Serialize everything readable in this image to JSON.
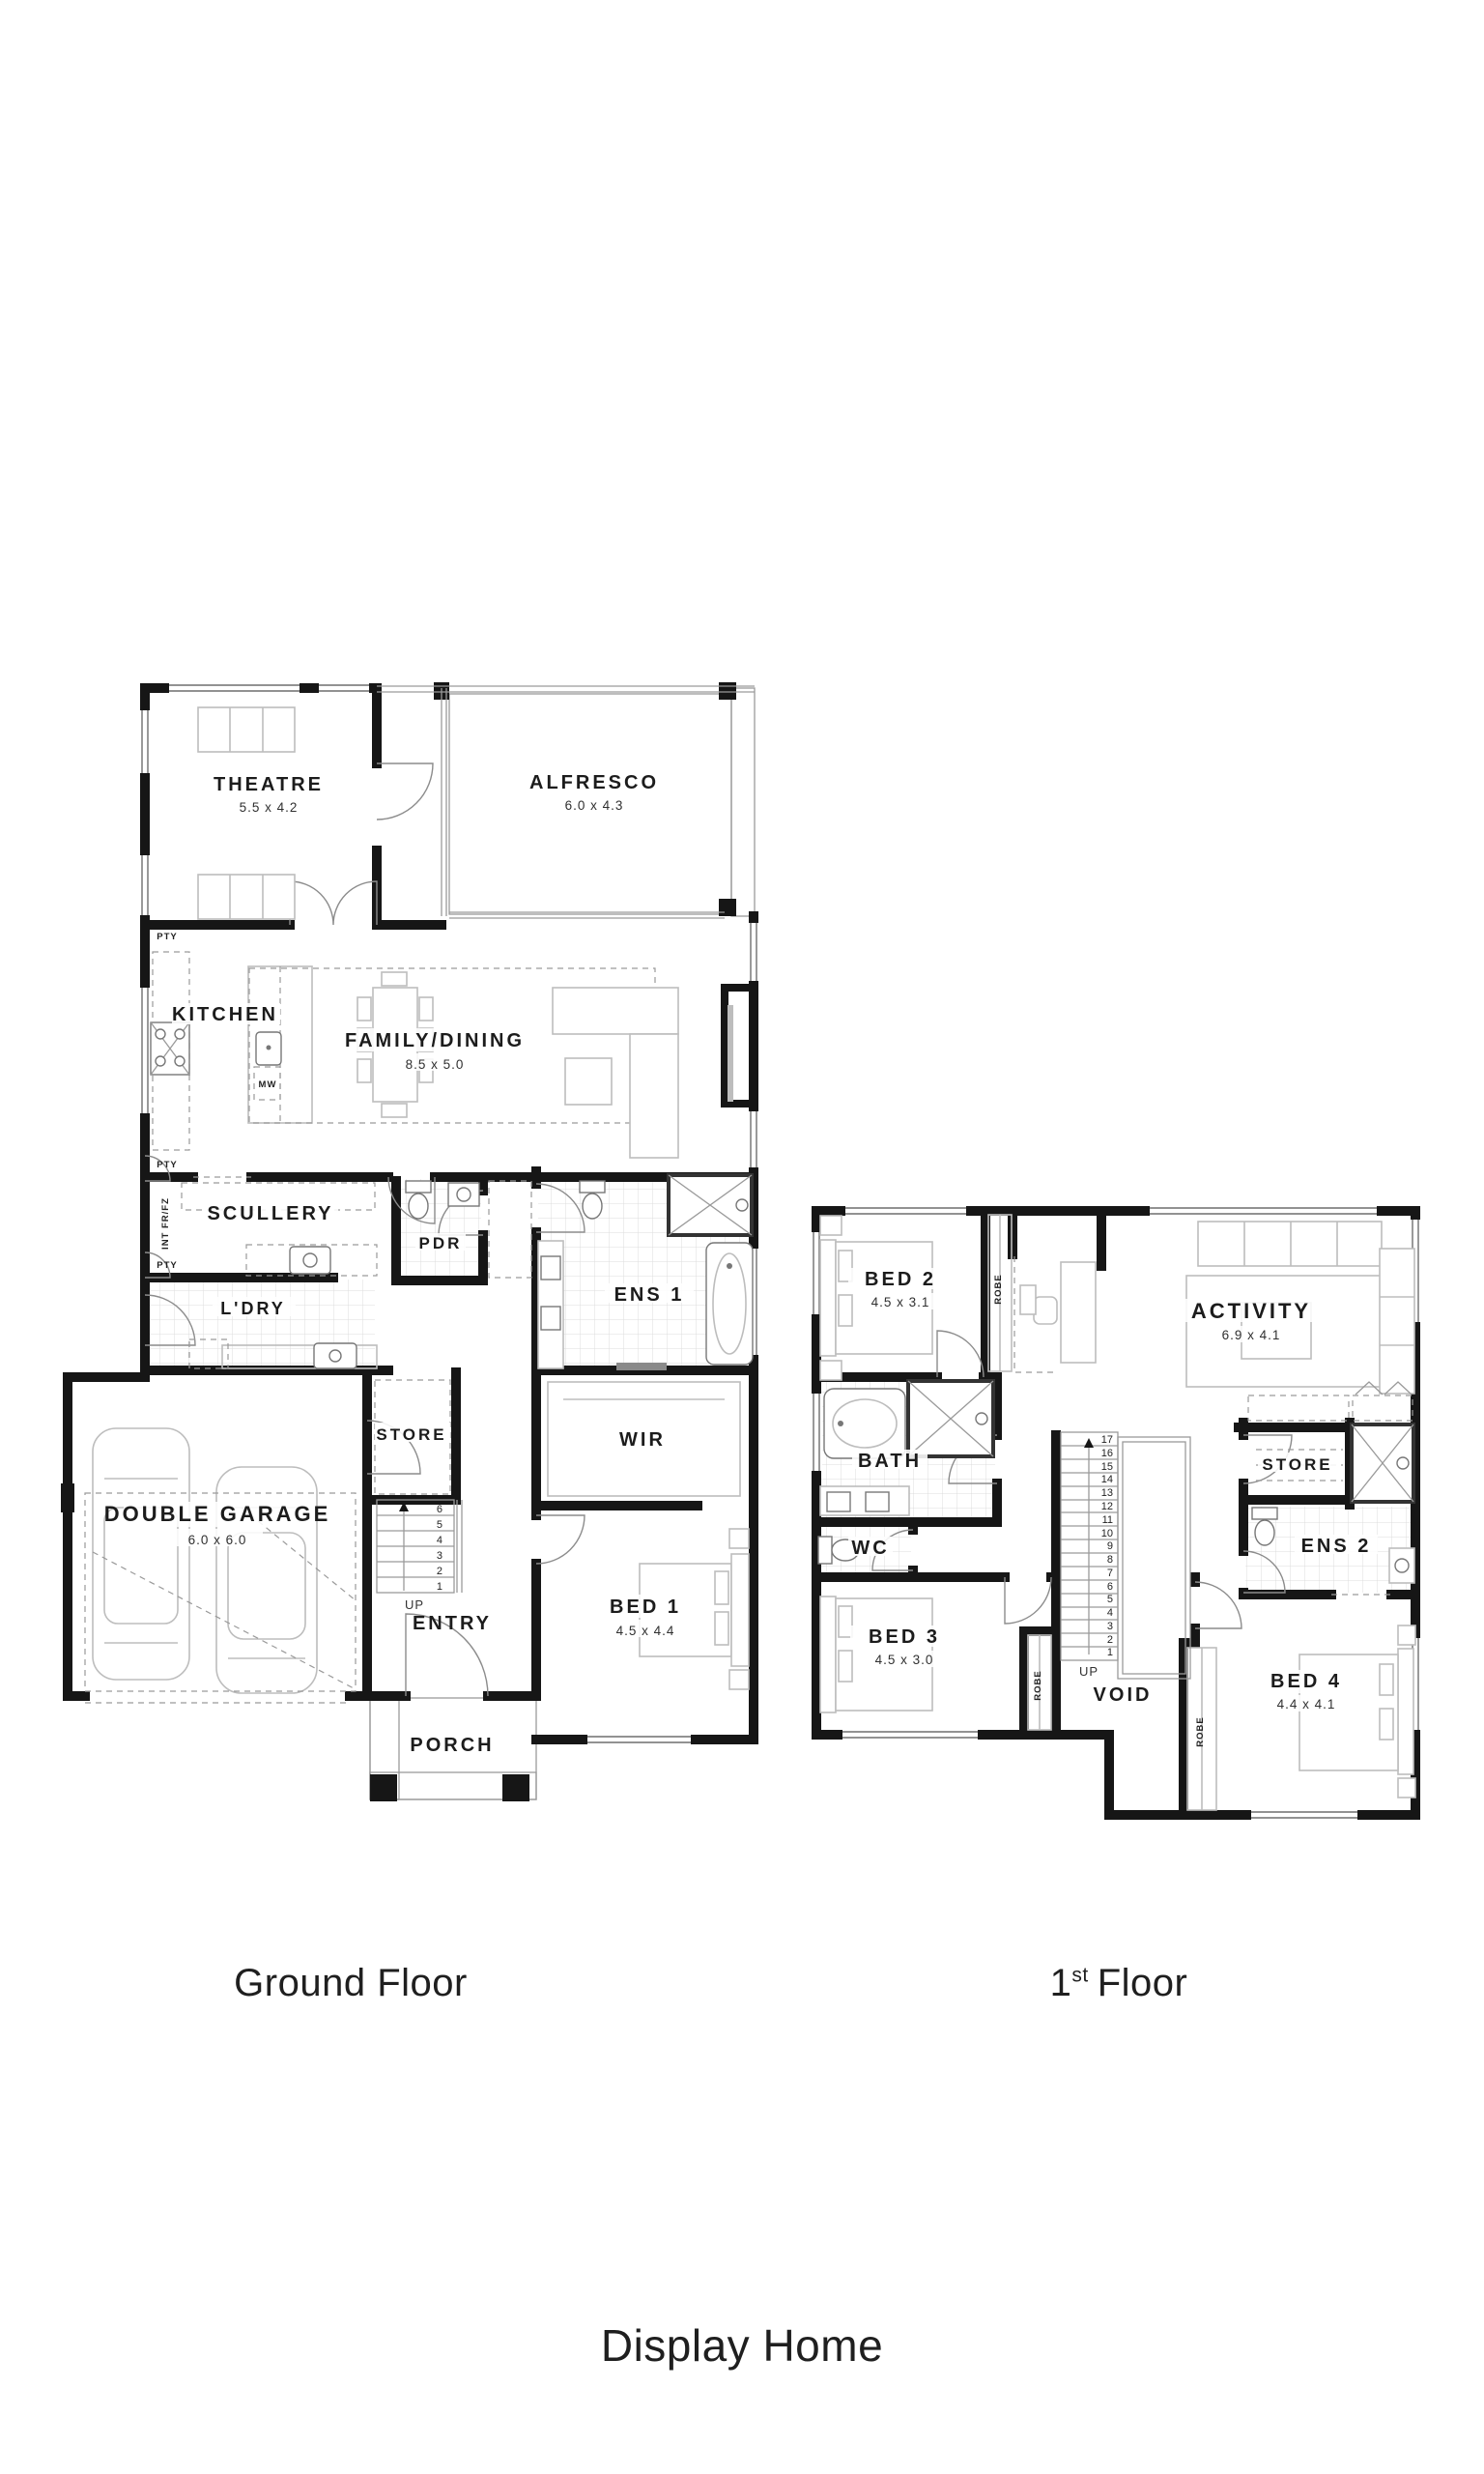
{
  "page": {
    "background": "#ffffff"
  },
  "footer": {
    "ground_floor_label": "Ground Floor",
    "first_floor_number": "1",
    "first_floor_ordinal": "st",
    "first_floor_word": "Floor",
    "brand": "Display Home"
  },
  "colors": {
    "wall": "#161616",
    "furniture": "#bdbdbd",
    "text": "#1c1c1c"
  },
  "ground_floor": {
    "rooms": [
      {
        "name": "THEATRE",
        "dims": "5.5 x 4.2"
      },
      {
        "name": "ALFRESCO",
        "dims": "6.0 x 4.3"
      },
      {
        "name": "KITCHEN"
      },
      {
        "name": "FAMILY/DINING",
        "dims": "8.5 x 5.0"
      },
      {
        "name": "SCULLERY"
      },
      {
        "name": "PDR"
      },
      {
        "name": "ENS 1"
      },
      {
        "name": "L'DRY"
      },
      {
        "name": "STORE"
      },
      {
        "name": "WIR"
      },
      {
        "name": "DOUBLE GARAGE",
        "dims": "6.0 x 6.0"
      },
      {
        "name": "ENTRY"
      },
      {
        "name": "BED 1",
        "dims": "4.5 x 4.4"
      },
      {
        "name": "PORCH"
      }
    ],
    "annotations": {
      "pty": [
        "PTY",
        "PTY",
        "PTY"
      ],
      "int_fridge": "INT FR/FZ",
      "microwave": "MW",
      "up": "UP"
    },
    "stair_numbers": [
      "1",
      "2",
      "3",
      "4",
      "5",
      "6"
    ]
  },
  "first_floor": {
    "rooms": [
      {
        "name": "BED 2",
        "dims": "4.5 x 3.1"
      },
      {
        "name": "ACTIVITY",
        "dims": "6.9 x 4.1"
      },
      {
        "name": "BATH"
      },
      {
        "name": "WC"
      },
      {
        "name": "STORE"
      },
      {
        "name": "ENS 2"
      },
      {
        "name": "BED 3",
        "dims": "4.5 x 3.0"
      },
      {
        "name": "VOID"
      },
      {
        "name": "BED 4",
        "dims": "4.4 x 4.1"
      }
    ],
    "annotations": {
      "robes": [
        "ROBE",
        "ROBE",
        "ROBE"
      ],
      "up": "UP"
    },
    "stair_numbers": [
      "1",
      "2",
      "3",
      "4",
      "5",
      "6",
      "7",
      "8",
      "9",
      "10",
      "11",
      "12",
      "13",
      "14",
      "15",
      "16",
      "17"
    ]
  }
}
